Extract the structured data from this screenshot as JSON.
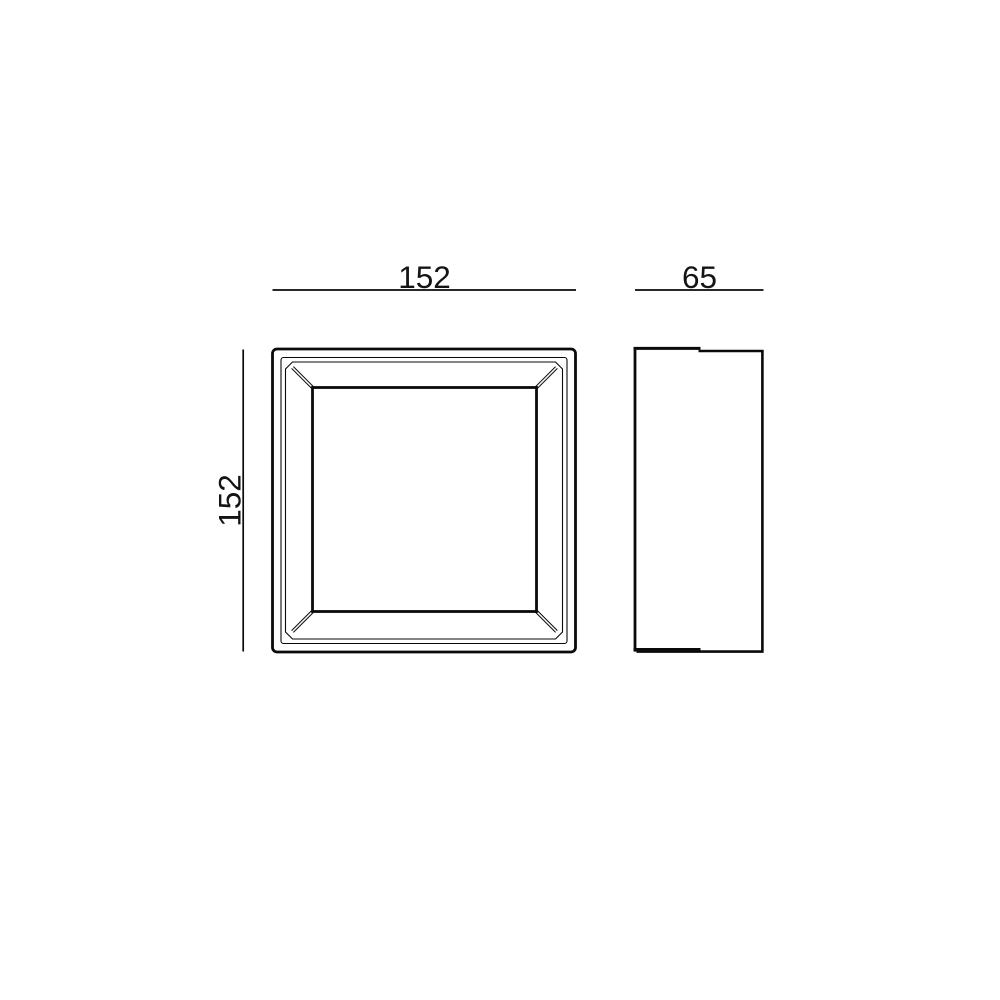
{
  "canvas": {
    "background": "#ffffff",
    "line_color": "#0a0a0a",
    "text_color": "#141413"
  },
  "drawing": {
    "type": "technical-dimension-drawing",
    "front_view": {
      "width_label": "152",
      "height_label": "152"
    },
    "side_view": {
      "depth_label": "65"
    }
  }
}
